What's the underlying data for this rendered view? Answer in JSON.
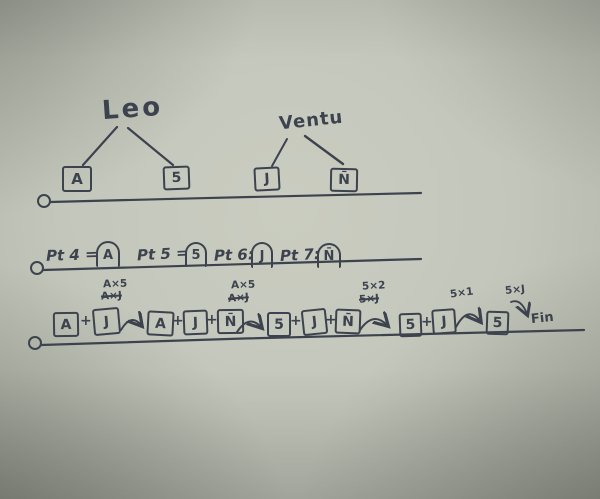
{
  "colors": {
    "ink": "#3d434e",
    "paper": "#c3c7bb"
  },
  "trees": [
    {
      "name": "Leo",
      "children": [
        {
          "label": "A"
        },
        {
          "label": "5"
        }
      ]
    },
    {
      "name": "Ventu",
      "children": [
        {
          "label": "J"
        },
        {
          "label": "N̄"
        }
      ]
    }
  ],
  "points": [
    {
      "prefix": "Pt 4 =",
      "value": "A"
    },
    {
      "prefix": "Pt 5 =",
      "value": "5"
    },
    {
      "prefix": "Pt 6:",
      "value": "J"
    },
    {
      "prefix": "Pt 7:",
      "value": "N̄"
    }
  ],
  "sequence": {
    "plus": "+",
    "steps": [
      {
        "terms": [
          "A",
          "J"
        ]
      },
      {
        "terms": [
          "A",
          "J",
          "N̄"
        ]
      },
      {
        "terms": [
          "5",
          "J",
          "N̄"
        ]
      },
      {
        "terms": [
          "5",
          "J"
        ]
      },
      {
        "terms": [
          "5"
        ]
      }
    ],
    "annotations": [
      {
        "kept": "A×5",
        "crossed": "A×J"
      },
      {
        "kept": "A×5",
        "crossed": "A×J"
      },
      {
        "kept": "5×2",
        "crossed": "5×J"
      },
      {
        "kept": "5×1"
      },
      {
        "kept": "5×J"
      }
    ],
    "fin": "Fin"
  }
}
